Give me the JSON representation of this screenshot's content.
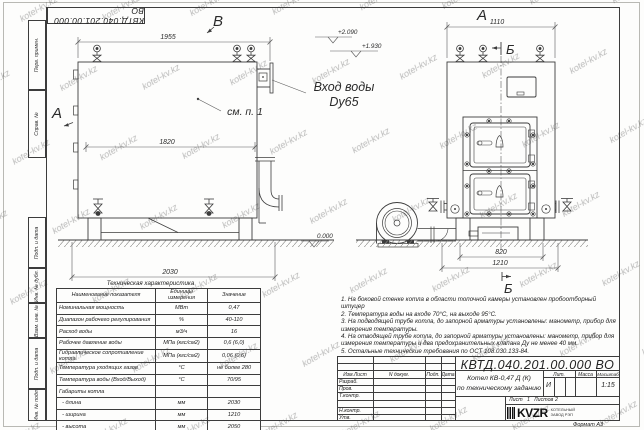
{
  "watermark": {
    "text": "kotel-kv.kz"
  },
  "stamp": {
    "doc_number": "КВТД.040.201.00.000 ВО"
  },
  "margin_labels": [
    "Перв. примен.",
    "Справ. №",
    "Подп. и дата",
    "Инв. № дубл.",
    "Взам. инв. №",
    "Подп. и дата",
    "Инв. № подл."
  ],
  "views": {
    "left": {
      "marker_top": "В",
      "marker_left": "А",
      "dim_width_top": "1955",
      "dim_width_inner": "1820",
      "dim_width_bottom": "2030",
      "elev_high": "+2.090",
      "elev_mid": "+1.930",
      "elev_zero": "0.000",
      "see_note": "см. п. 1",
      "inlet_label_line1": "Вход воды",
      "inlet_label_line2": "Dy65"
    },
    "right": {
      "marker_top": "А",
      "section_marker_top": "Б",
      "section_marker_bottom": "Б",
      "dim_width_top": "1110",
      "dim_base": "820",
      "dim_overall": "1210"
    }
  },
  "tech_table": {
    "caption": "Техническая характеристика",
    "headers": [
      "Наименование показателя",
      "Единицы измерения",
      "Значение"
    ],
    "rows": [
      [
        "Номинальная мощность",
        "МВт",
        "0,47"
      ],
      [
        "Диапазон рабочего регулирования",
        "%",
        "40-110"
      ],
      [
        "Расход воды",
        "м3/ч",
        "16"
      ],
      [
        "Рабочее давление воды",
        "МПа (кгс/см2)",
        "0,6 (6,0)"
      ],
      [
        "Гидравлическое сопротивление котла",
        "МПа (кгс/см2)",
        "0,06 (0,6)"
      ],
      [
        "Температура уходящих газов",
        "°С",
        "не более 280"
      ],
      [
        "Температура воды (Вход/Выход)",
        "°С",
        "70/95"
      ],
      [
        "Габариты котла",
        "",
        ""
      ],
      [
        "  - длина",
        "мм",
        "2030"
      ],
      [
        "  - ширина",
        "мм",
        "1210"
      ],
      [
        "  - высота",
        "мм",
        "2050"
      ]
    ]
  },
  "notes": [
    "1.  На боковой стенке котла в области топочной камеры установлен пробоотборный штуцер",
    "2.  Температура воды на входе  70°С,  на выходе  95°С.",
    "3.  На подводящей трубе котла, до запорной арматуры установлены:  манометр,  прибор для измерения температуры.",
    "4.  На отводящей трубе котла, до запорной арматуры установлены:  манометр,  прибор для измерения температуры и два предохранительных клапана  Ду не менее  40 мм.",
    "5.  Остальные технические требования по ОСТ 108.030.133-84."
  ],
  "title_block": {
    "doc_number": "КВТД.040.201.00.000  ВО",
    "col_headers": [
      "Изм.Лист",
      "N докум.",
      "Подп.",
      "Дата"
    ],
    "row_labels": [
      "Разраб.",
      "Пров.",
      "Т.контр.",
      "",
      "Н.контр.",
      "Утв."
    ],
    "product_title_line1": "Котел  КВ-0,47 Д (К)",
    "product_title_line2": "по техническому заданию",
    "lit_label": "Лит.",
    "lit_value": "И",
    "mass_label": "Масса",
    "scale_label": "Масштаб",
    "scale_value": "1:15",
    "sheet_label": "Лист",
    "sheet_value": "1",
    "sheets_label": "Листов",
    "sheets_value": "2",
    "logo_text": "KVZR",
    "org_line1": "КОТЕЛЬНЫЙ",
    "org_line2": "ЗАВОД РЭП",
    "format_label": "Формат   А3"
  }
}
